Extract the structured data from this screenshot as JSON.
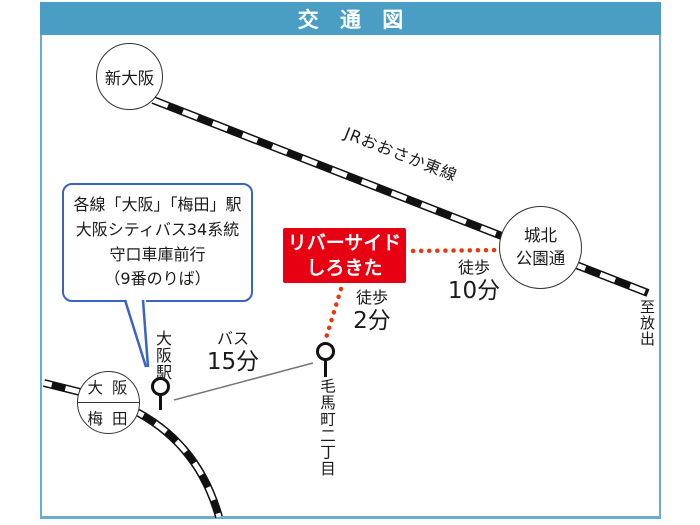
{
  "title": "交 通 図",
  "railway": {
    "jr_line_label": "JRおおさか東線",
    "to_destination": "至放出"
  },
  "stations": {
    "shin_osaka": "新大阪",
    "shirokita_line1": "城北",
    "shirokita_line2": "公園通",
    "osaka": "大 阪",
    "umeda": "梅 田"
  },
  "bus_stops": {
    "osaka_station": "大阪駅",
    "kemacho": "毛馬町二丁目"
  },
  "destination_box": {
    "line1": "リバーサイド",
    "line2": "しろきた"
  },
  "info_box": {
    "line1": "各線「大阪」「梅田」駅",
    "line2": "大阪シティバス34系統",
    "line3": "守口車庫前行",
    "line4": "（9番のりば）"
  },
  "routes": {
    "bus": {
      "label": "バス",
      "time": "15分"
    },
    "walk_short": {
      "label": "徒歩",
      "time": "2分"
    },
    "walk_long": {
      "label": "徒歩",
      "time": "10分"
    }
  },
  "colors": {
    "header_teal": "#4a9dc3",
    "frame_border_teal": "#66adce",
    "highlight_red": "#e60012",
    "dotted_route_red": "#e8380d",
    "callout_blue": "#3a63c2",
    "bus_line_gray": "#777777",
    "railway_black": "#111111"
  }
}
